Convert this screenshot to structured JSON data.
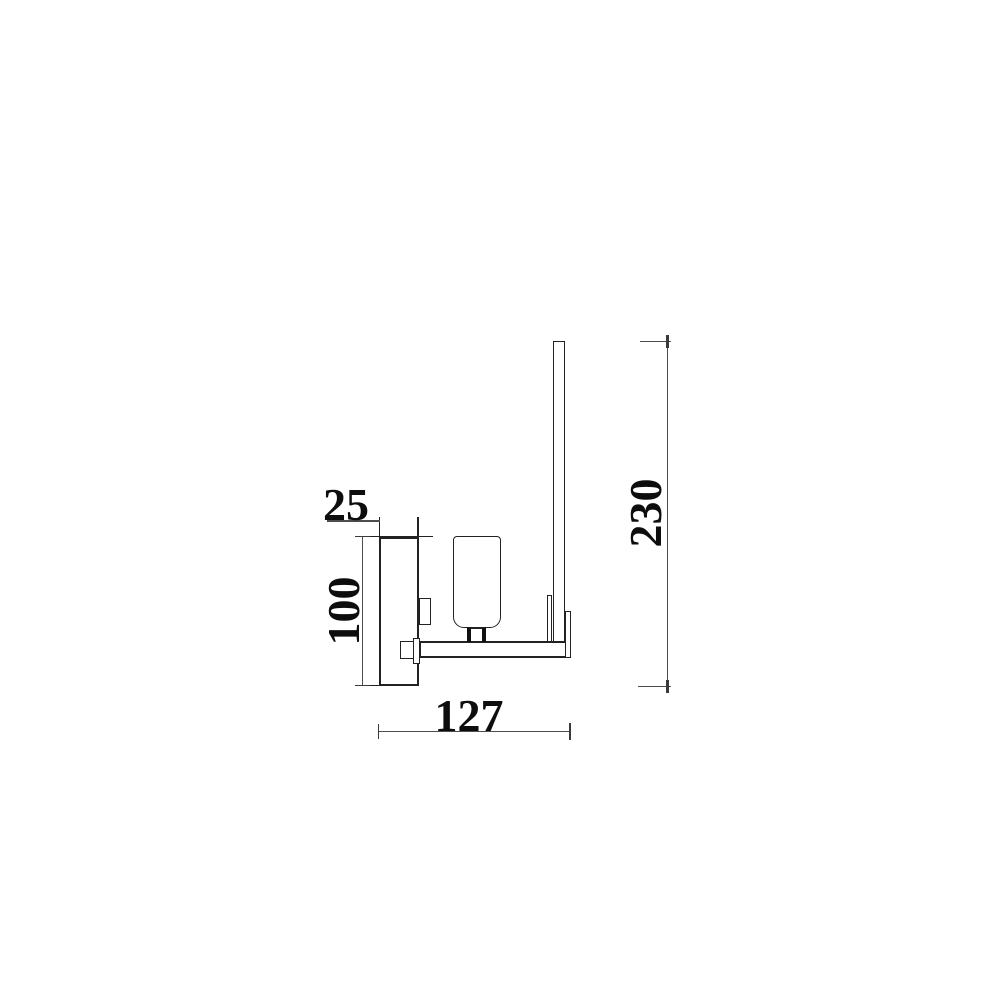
{
  "drawing": {
    "type": "technical-dimension-drawing",
    "view": "wall-light-side-elevation",
    "dimensions": [
      {
        "name": "backplate-depth",
        "value": "25"
      },
      {
        "name": "backplate-height",
        "value": "100"
      },
      {
        "name": "arm-length",
        "value": "127"
      },
      {
        "name": "overall-height",
        "value": "230"
      }
    ],
    "colors": {
      "object_line": "#222222",
      "dimension_line": "#4d4d4d",
      "label_text": "#0d0d0d",
      "background": "#ffffff"
    }
  }
}
